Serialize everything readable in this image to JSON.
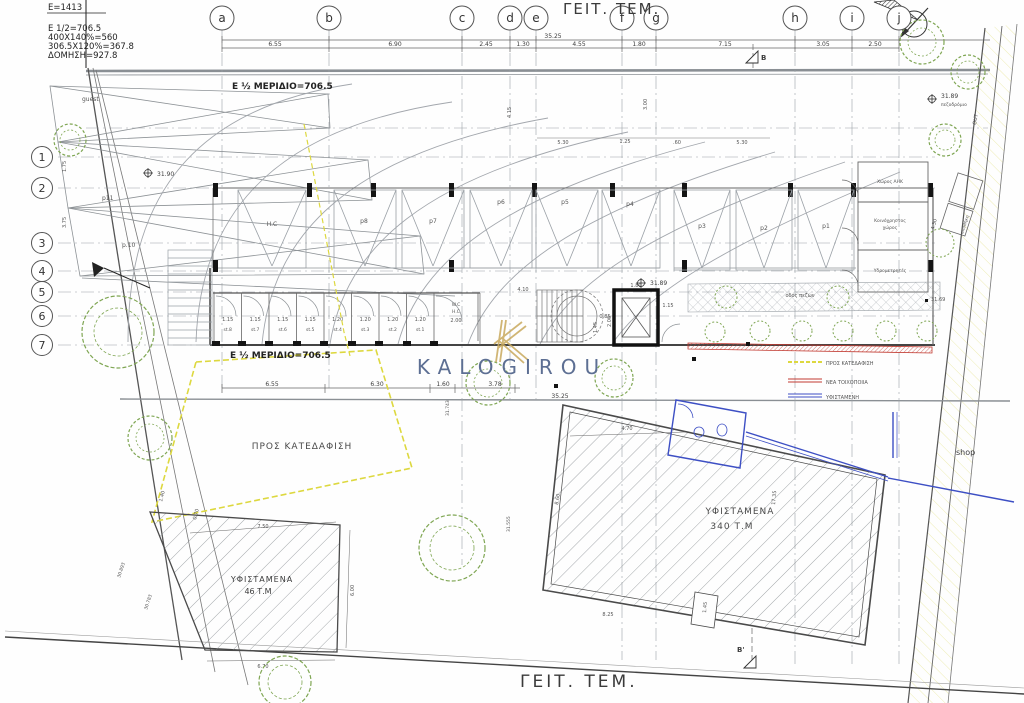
{
  "colors": {
    "demolition_yellow": "#ddd83f",
    "new_masonry_red": "#c23b32",
    "existing_blue": "#3d4fc4",
    "tree_green": "#7fa653",
    "watermark_blue": "#5d6f93",
    "logo_gold": "#c8a95d"
  },
  "calc": {
    "lines": [
      "E=1413",
      "E 1/2=706.5",
      "400X140%=560",
      "306.5X120%=367.8",
      "ΔΟΜΗΣΗ=927.8"
    ]
  },
  "neighbors": {
    "top": "ΓΕΙΤ. ΤΕΜ.",
    "bottom": "ΓΕΙΤ. ΤΕΜ."
  },
  "grid": {
    "cols": [
      "a",
      "b",
      "c",
      "d",
      "e",
      "f",
      "g",
      "h",
      "i",
      "j"
    ],
    "rows": [
      "1",
      "2",
      "3",
      "4",
      "5",
      "6",
      "7"
    ]
  },
  "dims": {
    "top_total": "35.25",
    "top": [
      "6.55",
      "6.90",
      "2.45",
      "1.30",
      "4.55",
      "1.80",
      "7.15",
      "3.05",
      "2.50"
    ],
    "mid": [
      "6.55",
      "6.30",
      "1.60",
      "3.78"
    ],
    "mid_total": "35.25",
    "left": [
      "1.75",
      "3.75"
    ],
    "inner": [
      "5.30",
      "1.25",
      ".60",
      "5.30",
      "4.15",
      "3.00",
      "4.10",
      "0.85",
      "1.80",
      "2.00",
      "1.15",
      "1.45",
      "4.30"
    ],
    "small46": [
      "7.50",
      "6.00",
      "6.70",
      "1.40",
      "0.70"
    ],
    "big340": [
      "4.70",
      "8.60",
      "17.35",
      "8.25",
      "1.45"
    ]
  },
  "share": {
    "text": "E ½ ΜΕΡΙΔΙΟ=706.5"
  },
  "parking": {
    "main": [
      "H.C",
      "p8",
      "p7",
      "p6",
      "p5",
      "p4",
      "p3",
      "p2",
      "p1"
    ],
    "left": [
      "guest",
      "p11",
      "p.10"
    ]
  },
  "storage": {
    "widths": [
      "1.15",
      "1.15",
      "1.15",
      "1.15",
      "1.20",
      "1.20",
      "1.20",
      "1.20"
    ],
    "names": [
      "st.8",
      "st.7",
      "st.6",
      "st.5",
      "st.4",
      "st.3",
      "st.2",
      "st.1"
    ],
    "wc": "W.C",
    "hc": "H.C",
    "wc_width": "2.00"
  },
  "rooms": {
    "r1": "Χώρος ΑΗΚ",
    "r2a": "Κοινόχρηστος",
    "r2b": "χώρος",
    "r3": "Υδρομετρητές",
    "r4": "αποθήκη"
  },
  "areas": {
    "demolish": "ΠΡΟΣ  ΚΑΤΕΔΑΦΙΣΗ",
    "big1": "ΥΦΙΣΤΑΜΕΝΑ",
    "big2": "340 Τ.Μ",
    "small1": "ΥΦΙΣΤΑΜΕΝΑ",
    "small2": "46 Τ.Μ",
    "shop": "shop",
    "walkway": "οδός πεζών"
  },
  "legend": {
    "demolish": "ΠΡΟΣ ΚΑΤΕΔΑΦΙΣΗ",
    "new": "ΝΕΑ ΤΟΙΧΟΠΟΙΙΑ",
    "existing": "ΥΦΙΣΤΑΜΕΝΗ"
  },
  "levels": {
    "a": "31.90",
    "b": "31.89",
    "c": "31.89",
    "d": "31.69",
    "e": "31.743",
    "f": "31.555",
    "g": "30.893",
    "h": "30.783",
    "sidewalk": "πεζοδρόμιο",
    "out": "OUT"
  },
  "sections": {
    "b": "B",
    "b_prime": "B'"
  },
  "watermark": {
    "text": "KALOGIROU"
  }
}
